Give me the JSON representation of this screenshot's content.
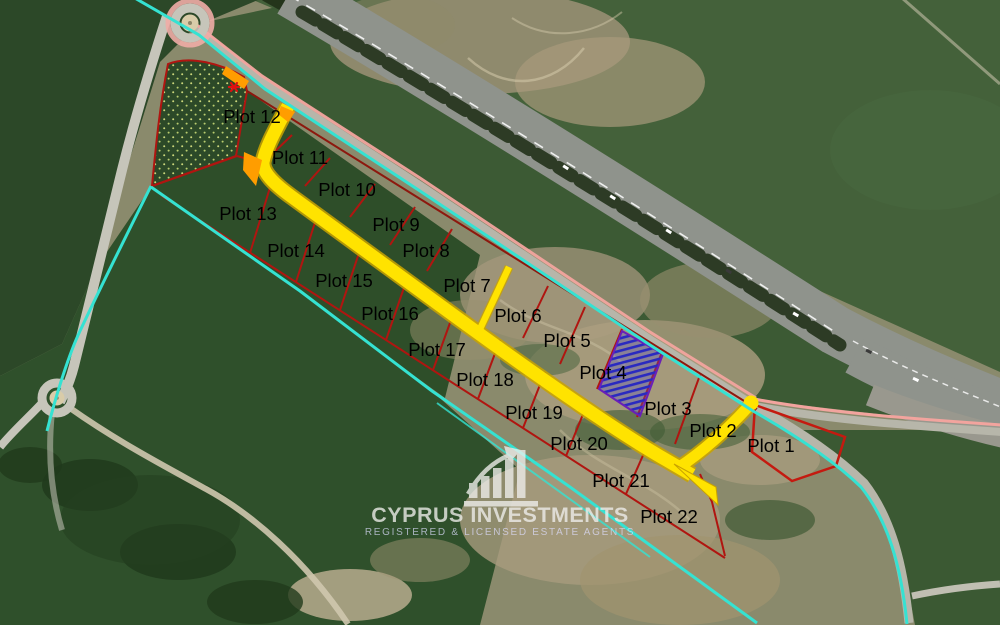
{
  "map": {
    "type": "satellite-plot-map",
    "plots": [
      {
        "label": "Plot 1",
        "x": 771,
        "y": 452
      },
      {
        "label": "Plot 2",
        "x": 713,
        "y": 437
      },
      {
        "label": "Plot 3",
        "x": 668,
        "y": 415
      },
      {
        "label": "Plot 4",
        "x": 603,
        "y": 379
      },
      {
        "label": "Plot 5",
        "x": 567,
        "y": 347
      },
      {
        "label": "Plot 6",
        "x": 518,
        "y": 322
      },
      {
        "label": "Plot 7",
        "x": 467,
        "y": 292
      },
      {
        "label": "Plot 8",
        "x": 426,
        "y": 257
      },
      {
        "label": "Plot 9",
        "x": 396,
        "y": 231
      },
      {
        "label": "Plot 10",
        "x": 347,
        "y": 196
      },
      {
        "label": "Plot 11",
        "x": 300,
        "y": 164
      },
      {
        "label": "Plot 12",
        "x": 252,
        "y": 123
      },
      {
        "label": "Plot 13",
        "x": 248,
        "y": 220
      },
      {
        "label": "Plot 14",
        "x": 296,
        "y": 257
      },
      {
        "label": "Plot 15",
        "x": 344,
        "y": 287
      },
      {
        "label": "Plot 16",
        "x": 390,
        "y": 320
      },
      {
        "label": "Plot 17",
        "x": 437,
        "y": 356
      },
      {
        "label": "Plot 18",
        "x": 485,
        "y": 386
      },
      {
        "label": "Plot 19",
        "x": 534,
        "y": 419
      },
      {
        "label": "Plot 20",
        "x": 579,
        "y": 450
      },
      {
        "label": "Plot 21",
        "x": 621,
        "y": 487
      },
      {
        "label": "Plot 22",
        "x": 669,
        "y": 523
      }
    ],
    "watermark": {
      "title": "CYPRUS INVESTMENTS",
      "subtitle": "REGISTERED & LICENSED ESTATE AGENTS",
      "icon": "growth-chart-icon"
    },
    "overlay_colors": {
      "parcel_boundary_cyan": "#35e2d2",
      "plot_lines_red": "#b01510",
      "access_road_yellow": "#ffe300",
      "reserved_plot_hatch_blue": "#2a2ac0",
      "reserved_plot_border_purple": "#6a1fb8",
      "service_road_edge_pink": "#f2a49e",
      "marker_orange": "#ff9d00",
      "marker_star_red": "#e01010",
      "label_text": "#000000"
    },
    "features": {
      "highway": "motorway running diagonally top-left to right edge",
      "roundabout_top_left": "roundabout at top left",
      "roundabout_mid_left": "roundabout at middle left",
      "reserved_plot": "blue hatched plot between Plot 4 and Plot 3",
      "green_dotted_area": "stippled green parcel at top left"
    }
  }
}
